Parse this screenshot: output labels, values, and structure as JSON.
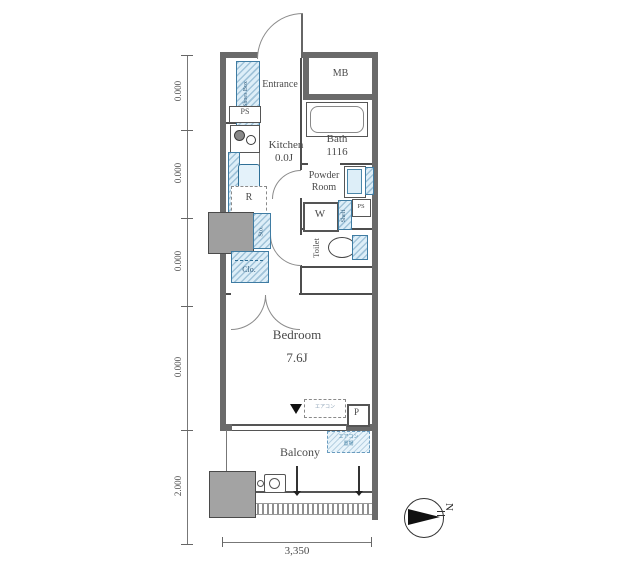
{
  "plan": {
    "rooms": {
      "entrance": "Entrance",
      "mb": "MB",
      "kitchen_name": "Kitchen",
      "kitchen_size": "0.0J",
      "bath_name": "Bath",
      "bath_size": "1116",
      "powder_line1": "Powder",
      "powder_line2": "Room",
      "toilet": "Toilet",
      "bedroom_name": "Bedroom",
      "bedroom_size": "7.6J",
      "balcony": "Balcony"
    },
    "fixtures": {
      "shoes_box": "Shoes Box",
      "ps_entrance": "PS",
      "ps_powder": "PS",
      "refrigerator": "R",
      "washer": "W",
      "shelf": "Shelf",
      "storage": "Sto.",
      "closet": "Clo.",
      "pipe_space": "P",
      "ac_note_room": "エアコン",
      "ac_note_balcony_1": "エアコン",
      "ac_note_balcony_2": "置場"
    },
    "dimensions": {
      "left": [
        "0.000",
        "0.000",
        "0.000",
        "0.000",
        "2.000"
      ],
      "bottom": "3,350"
    },
    "compass": {
      "north": "N"
    },
    "colors": {
      "wall": "#6a6a6a",
      "partition": "#4d4d4d",
      "fixture_blue_fill": "#ddeef8",
      "fixture_blue_border": "#3f7ca3",
      "pillar_gray": "#9f9f9f"
    }
  }
}
